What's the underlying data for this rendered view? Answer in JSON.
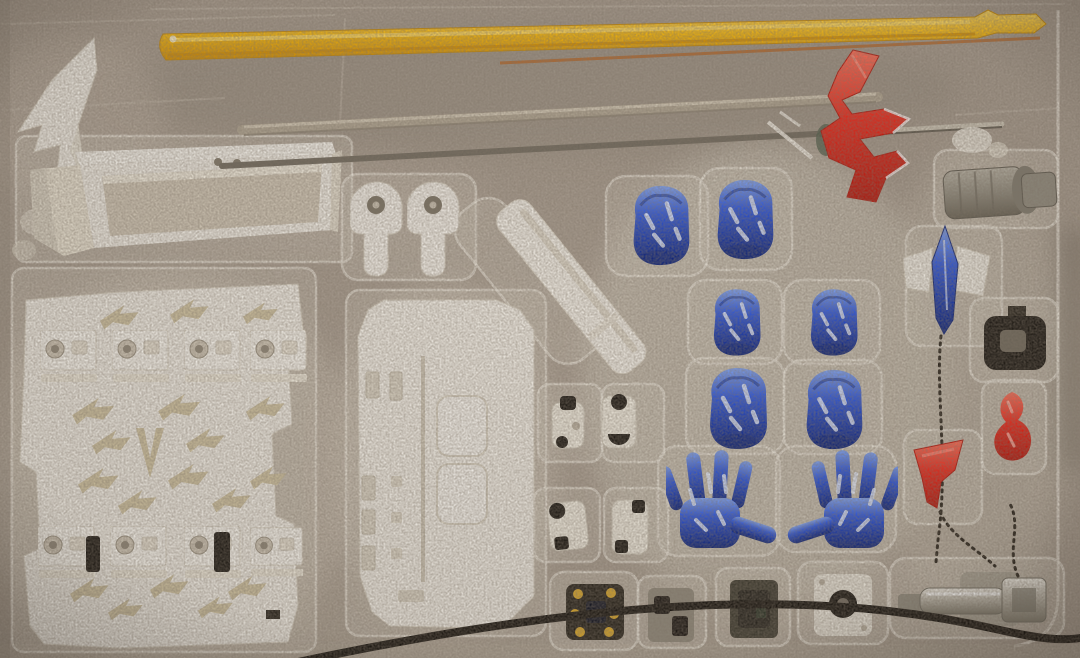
{
  "meta": {
    "description": "Photograph of a model kit blister tray holding accessory parts: yellow effect rod, white armor/stand parts, blue fists and open hands, red lightning bolt, metal rods, small joints and a black cable.",
    "scene_type": "photograph"
  },
  "palette": {
    "tray_base": "#a79b8e",
    "tray_mid": "#b8ad9f",
    "tray_light": "#cfc6b8",
    "tray_dark": "#8a7f72",
    "pocket_fill": "#d8d1c4",
    "pocket_rim": "#f2ede3",
    "part_white": "#f1ede5",
    "part_white_dim": "#ddd6c8",
    "part_cream": "#e9e2d2",
    "inner_channel": "#cec4b2",
    "watermark": "#cfc2a0",
    "hole_gray": "#8a8172",
    "yellow_hi": "#ffd95e",
    "yellow_main": "#f6b70a",
    "yellow_dark": "#d28d00",
    "orange_line": "#b95a10",
    "tube_beige": "#b3a794",
    "rod_dark": "#6e675b",
    "rod_silver": "#cdc6b7",
    "red_hi": "#ff6b55",
    "red_main": "#ea2417",
    "red_dark": "#b31208",
    "blue_hi": "#7da2f5",
    "blue_main": "#2b55dd",
    "blue_deep": "#12309f",
    "blue_dark": "#0a2076",
    "black_part": "#191510",
    "gray_hi": "#b6b1a4",
    "gray_metal": "#8f8a7d",
    "gray_dark": "#655f52",
    "chrome_hi": "#f1eee6",
    "chrome_mid": "#b9b4a8",
    "chrome_dark": "#7b7668",
    "gold": "#d9a627",
    "cable": "#15110c",
    "chain": "#241e16",
    "green_bit": "#4e5c4a"
  },
  "parts": [
    {
      "id": "yellow-effect-rod",
      "label": "Yellow effect rod / spear shaft",
      "color": "yellow",
      "count": 1
    },
    {
      "id": "wing-fin",
      "label": "White wing fin part",
      "color": "white",
      "count": 1
    },
    {
      "id": "stand-beam",
      "label": "White stand beam channel",
      "color": "white",
      "count": 1
    },
    {
      "id": "clear-tube",
      "label": "Clear/beige tube",
      "color": "beige",
      "count": 1
    },
    {
      "id": "metal-rod",
      "label": "Long metal rod",
      "color": "gray",
      "count": 1
    },
    {
      "id": "red-lightning",
      "label": "Red lightning bolt part",
      "color": "red",
      "count": 1
    },
    {
      "id": "joint-covers",
      "label": "White keyhole joint covers",
      "color": "white",
      "count": 2
    },
    {
      "id": "blade-holder",
      "label": "White diagonal blade holder",
      "color": "white",
      "count": 1
    },
    {
      "id": "clip-panel",
      "label": "White clip panel with 8 clips and arrow embossing",
      "color": "white",
      "count": 1
    },
    {
      "id": "base-plate",
      "label": "White display base plate",
      "color": "white",
      "count": 1
    },
    {
      "id": "blue-fists",
      "label": "Blue fist hands",
      "color": "blue",
      "count": 6
    },
    {
      "id": "blue-open-hands",
      "label": "Blue open spread hands",
      "color": "blue",
      "count": 2
    },
    {
      "id": "blue-spear",
      "label": "Blue pointed spear tip with white fins",
      "color": "blue",
      "count": 1
    },
    {
      "id": "gray-barrel",
      "label": "Gray barrel cylinder",
      "color": "gray",
      "count": 1
    },
    {
      "id": "black-connector",
      "label": "Black connector block",
      "color": "black",
      "count": 1
    },
    {
      "id": "red-nozzle",
      "label": "Small red nozzle part",
      "color": "red",
      "count": 1
    },
    {
      "id": "red-funnel",
      "label": "Red funnel cone",
      "color": "red",
      "count": 1
    },
    {
      "id": "mini-joints",
      "label": "Small black/white articulation joints",
      "color": "mixed",
      "count": 4
    },
    {
      "id": "gold-thruster",
      "label": "Dark thruster with gold dots",
      "color": "black-gold",
      "count": 1
    },
    {
      "id": "dark-joints-row",
      "label": "Dark small parts bottom row",
      "color": "dark",
      "count": 2
    },
    {
      "id": "socket-ring",
      "label": "White socket with black ring",
      "color": "white-black",
      "count": 1
    },
    {
      "id": "chrome-coupler",
      "label": "Chrome coupler assembly with chain",
      "color": "chrome",
      "count": 1
    },
    {
      "id": "black-cable",
      "label": "Black cable across tray bottom",
      "color": "black",
      "count": 1
    }
  ]
}
